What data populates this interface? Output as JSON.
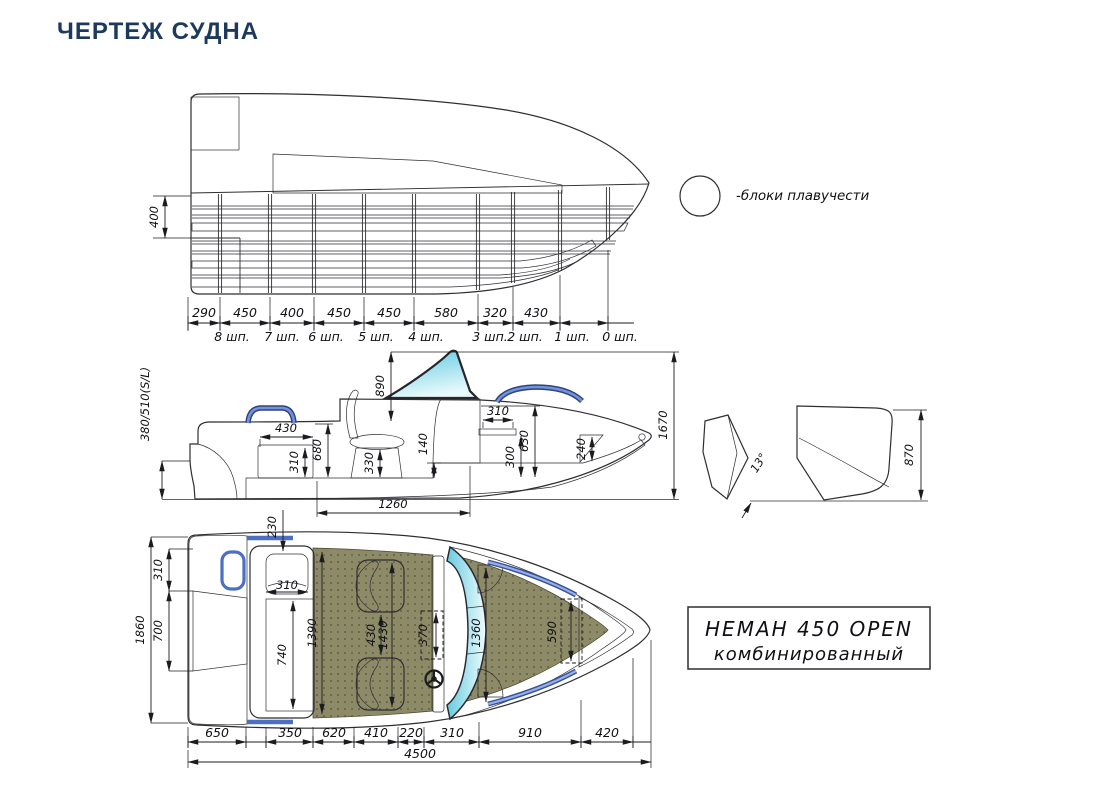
{
  "title": "ЧЕРТЕЖ СУДНА",
  "legend": {
    "text": "-блоки плавучести"
  },
  "structural": {
    "height": "400",
    "segments": [
      "290",
      "450",
      "400",
      "450",
      "450",
      "580",
      "320",
      "430"
    ],
    "stations": [
      "8 шп.",
      "7 шп.",
      "6 шп.",
      "5 шп.",
      "4 шп.",
      "3 шп.",
      "2 шп.",
      "1 шп.",
      "0 шп."
    ]
  },
  "profile": {
    "transom_height": "380/510(S/L)",
    "windshield": "890",
    "seat_width": "430",
    "seat_height": "310",
    "depth": "680",
    "pedestal": "330",
    "step": "140",
    "shelf_w": "310",
    "shelf_h": "300",
    "console": "630",
    "bow_seat": "240",
    "height": "1670",
    "cockpit_len": "1260"
  },
  "transom": {
    "deadrise": "13°",
    "height": "870"
  },
  "plan": {
    "beam": "1860",
    "platform": "310",
    "well": "700",
    "headrest": "230",
    "cushion": "310",
    "bench": "740",
    "cockpit_w": "1390",
    "gap": "430",
    "span": "1430",
    "console_w": "370",
    "bow_w": "1360",
    "bow_seat": "590",
    "segments": [
      "650",
      "350",
      "620",
      "410",
      "220",
      "310",
      "910",
      "420"
    ],
    "total": "4500"
  },
  "model": {
    "line1": "НЕМАН 450 OPEN",
    "line2": "комбинированный"
  },
  "colors": {
    "accent_title": "#1d3a5c",
    "hull_gray": "#d8d8d8",
    "floor_olive": "#8d8a68",
    "seat_orange": "#e7a71f",
    "seat_blue": "#72aadf",
    "console_green": "#3e9078",
    "rail_blue": "#4a6fc4",
    "windshield_cyan": "#67cbe0"
  }
}
